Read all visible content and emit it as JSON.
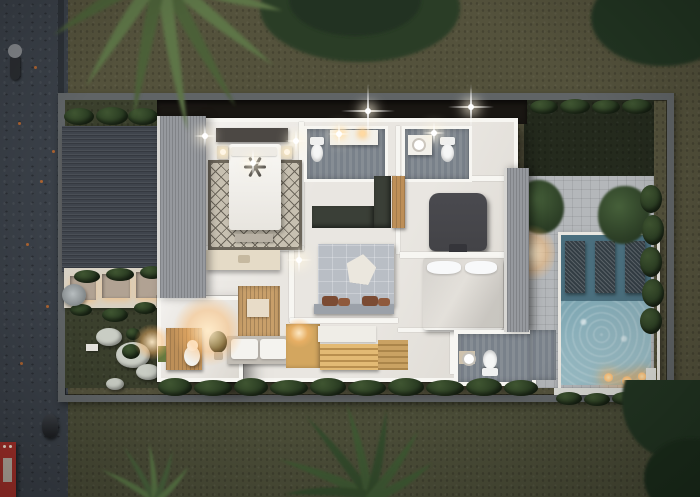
{
  "meta": {
    "type": "3d-architectural-render",
    "view": "top-down aerial cutaway",
    "time_of_day": "dusk",
    "subject": "villa upper-floor plan with pool terrace, gardens, carport and street"
  },
  "palette": {
    "road": "#3a4048",
    "road-light": "#454b54",
    "curb": "#2c3137",
    "lawn-outer": "#54523c",
    "lawn-bottom": "#4a4c37",
    "lawn-inner": "#3b402d",
    "lawn-dark": "#242a1d",
    "wall": "#606466",
    "deck": "#b4b7ba",
    "carport": "#3f444c",
    "roofstrip": "#96999e",
    "floor": "#e9e6e1",
    "white-wall": "#f7f6f2",
    "bathfloor-a": "#868d94",
    "bathfloor-b": "#79818a",
    "ward-dark": "#3a3f37",
    "wood": "#bd8f58",
    "wood-light": "#c89f6a",
    "stair": "#d3a65f",
    "stair-dark": "#b98f4e",
    "rug": "#c7c0b1",
    "rug-line": "#6b655a",
    "duvet": "#b9bec5",
    "pentagon": "#ebe7de",
    "pillow-brown": "#7b4b33",
    "headboard-gray": "#9ba1a9",
    "chair-dark": "#434347",
    "bed-white": "#e8e5df",
    "pool-shelf": "#4a6f7e",
    "pool-deep": "#8fb3bd",
    "lounger-mesh": "#333d44",
    "hedge-a": "#3f5531",
    "hedge-b": "#283a21",
    "canopy": "#2b3d25",
    "frond-a": "#5d7546",
    "frond-b": "#4b6138",
    "cream": "#d8d2c5",
    "gravel": "#b1a293",
    "stone": "#c9cdc4",
    "warm": "#ffc27a",
    "red": "#a5302a",
    "dark-strip": "#1a1713",
    "water-feature": "#8f9597"
  },
  "scene": {
    "street": {
      "surface": "dark asphalt with fallen orange leaves",
      "vehicles": [
        {
          "name": "motorcycle-with-rider",
          "position": "top of road"
        },
        {
          "name": "parked-scooter",
          "position": "lower road"
        },
        {
          "name": "red-truck",
          "position": "bottom-left corner",
          "color": "#a5302a"
        }
      ]
    },
    "property": {
      "boundary": "grey concrete perimeter wall",
      "entry_garden": {
        "walkway": "cream stone",
        "gravel_planters": 3,
        "lit_edges": true,
        "water_feature": "small rock fountain",
        "stepping_stones_with_plants": true
      },
      "carport_roof": "dark slatted roof",
      "hedges": [
        "north row",
        "east row",
        "south row along house",
        "pool planter"
      ]
    },
    "house": {
      "floor_finish": "white marble",
      "rooms": [
        {
          "id": "master-bedroom",
          "items": [
            "double-bed",
            "ceiling-fan",
            "diamond-pattern-rug",
            "nightstand-lamps",
            "tv-console",
            "foot-bench"
          ]
        },
        {
          "id": "bathroom-north-left",
          "items": [
            "toilet",
            "double-vanity-with-lights"
          ]
        },
        {
          "id": "bathroom-north-right",
          "items": [
            "round-basin-vanity",
            "toilet"
          ]
        },
        {
          "id": "walk-in-wardrobe",
          "items": [
            "dark-cabinet-run",
            "tall-wood-cabinet"
          ]
        },
        {
          "id": "bedroom-center",
          "items": [
            "bed-with-pentagon-throw",
            "brown-accent-pillows",
            "grey-headboard"
          ]
        },
        {
          "id": "bedroom-east",
          "items": [
            "dark-armchair",
            "white-bed-with-pillows",
            "shelf-divider"
          ]
        },
        {
          "id": "vanity-room",
          "items": [
            "cream-counter-with-basin"
          ]
        },
        {
          "id": "foyer-lounge",
          "items": [
            "wood-slat-feature-wall",
            "artwork",
            "cushioned-daybed",
            "potted-plant"
          ]
        },
        {
          "id": "staircase",
          "items": [
            "golden-wood-treads",
            "white-landing"
          ]
        },
        {
          "id": "bathroom-south",
          "items": [
            "round-basin",
            "toilet",
            "beige-mat"
          ]
        },
        {
          "id": "powder-room",
          "items": [
            "wood-bench",
            "white-stool",
            "green-towel"
          ]
        }
      ]
    },
    "pool_terrace": {
      "paving": "light grey stone grid",
      "pool": {
        "shape": "rectangular",
        "tanning_shelf_loungers": 3,
        "underwater_warm_lights": 3,
        "shimmering_water": true
      },
      "trees": 2,
      "warm_deck_glow": true
    },
    "vegetation": [
      "palm-fronds-top-left",
      "tree-canopy-top-center",
      "tree-canopy-top-right",
      "bottom-palm",
      "bottom-left-ferns",
      "bottom-right-bush"
    ],
    "lighting": {
      "white-sparkle-lights": 7,
      "warm-flares": 4,
      "pool-lights": 3
    }
  }
}
